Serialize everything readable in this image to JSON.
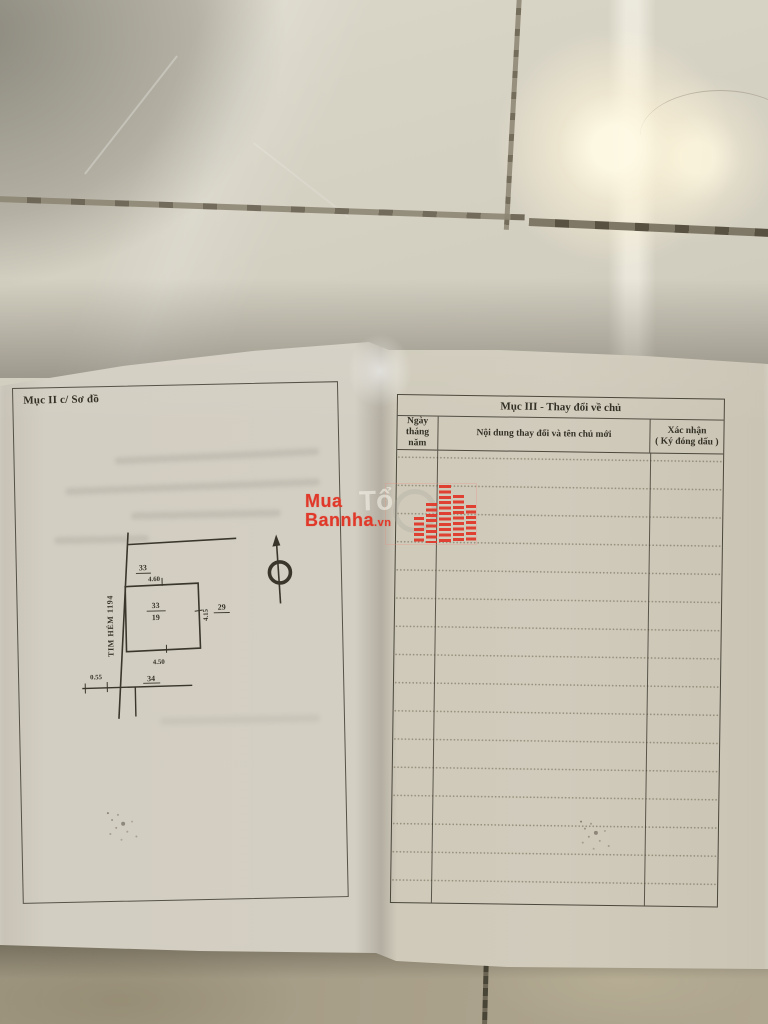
{
  "left_page": {
    "title": "Mục II c/ Sơ đồ",
    "diagram": {
      "road_label": "TIM HẺM 1194",
      "parcel_top": "33",
      "dim_top": "4.60",
      "center_numerator": "33",
      "center_denominator": "19",
      "parcel_right": "29",
      "dim_right": "4.15",
      "dim_bottom": "4.50",
      "dim_offset": "0.55",
      "parcel_bottom": "34"
    }
  },
  "right_page": {
    "table_title": "Mục III - Thay đổi về chủ",
    "col_date_line1": "Ngày tháng",
    "col_date_line2": "năm",
    "col_content": "Nội dung thay đổi và tên chủ mới",
    "col_confirm_line1": "Xác nhận",
    "col_confirm_line2": "( Ký đóng dấu )"
  },
  "watermark": {
    "line1": "Mua",
    "line2": "Bannha",
    "suffix": ".vn",
    "ghost_text": "Tổ",
    "color": "#e0392a"
  },
  "colors": {
    "ink": "#3a362c",
    "paper_left": "#d3cec2",
    "paper_right": "#d0cabb",
    "tile_upper": "#d6d2c4",
    "floor_lower": "#a89f89",
    "watermark_red": "#e0392a"
  }
}
